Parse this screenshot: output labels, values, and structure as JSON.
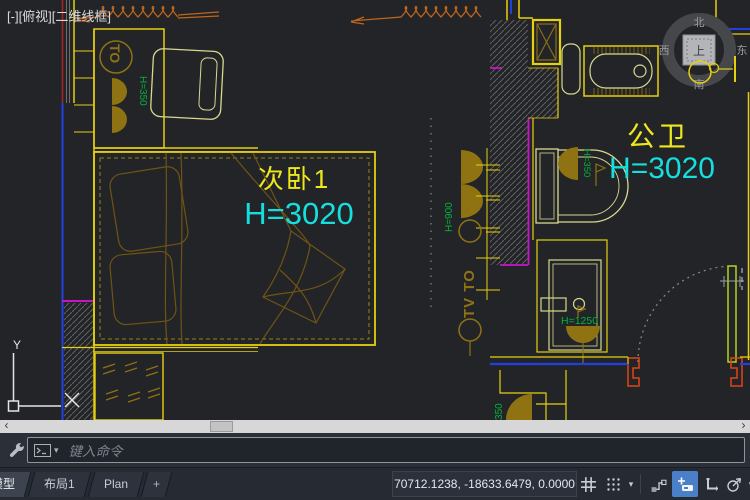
{
  "viewport_controls": {
    "collapse": "[-]",
    "view": "[俯视]",
    "visual_style": "[二维线框]"
  },
  "view_cube": {
    "north": "北",
    "west": "西",
    "east": "东",
    "south": "南",
    "top": "上"
  },
  "ucs_icon": {
    "x_label": "X",
    "y_label": "Y"
  },
  "drawing": {
    "rooms": [
      {
        "name": "次卧1",
        "height": "H=3020"
      },
      {
        "name": "公卫",
        "height": "H=3020"
      }
    ],
    "annotations": {
      "dresser_outlet": "TO",
      "dresser_height": "H=350",
      "wall_height": "H=900",
      "wall_tv_outlet": "TV TO",
      "toilet_height": "H=350",
      "shower_height": "H=1250",
      "corner_height": "H=350"
    }
  },
  "command_bar": {
    "placeholder": "键入命令"
  },
  "status_bar": {
    "tabs": [
      {
        "label": "模型",
        "active": true
      },
      {
        "label": "布局1",
        "active": false
      },
      {
        "label": "Plan",
        "active": false
      },
      {
        "label": "+",
        "active": false
      }
    ],
    "coordinates": "70712.1238, -18633.6479, 0.0000",
    "icons": [
      "grid-display",
      "snap-mode",
      "infer-constraints",
      "dynamic-input",
      "ortho-mode",
      "polar-tracking"
    ]
  },
  "glyphs": {
    "caret_down": "▾",
    "scroll_left": "‹",
    "scroll_right": "›"
  },
  "palette": {
    "canvas_bg": "#232428",
    "wall_yellow": "#e6d00e",
    "fixture_pale": "#d9d98e",
    "symbol_olive": "#8f7312",
    "bed_brown": "#6e5414",
    "annotation_green": "#00b43c",
    "height_cyan": "#15dede",
    "room_label_yellow": "#ece81c",
    "window_magenta": "#c814c8",
    "wall_blue": "#2240e0",
    "curtain_orange": "#c0661a",
    "door_jamb_orange": "#e04414",
    "door_leaf_green": "#b0d41e",
    "accent_blue": "#4a80c8"
  }
}
